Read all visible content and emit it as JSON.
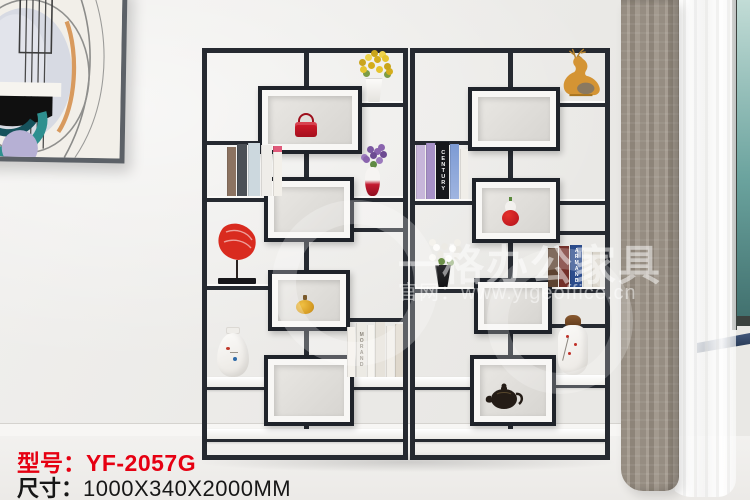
{
  "product": {
    "model_label": "型号：",
    "model_value": "YF-2057G",
    "size_label": "尺寸：",
    "size_value": "1000X340X2000MM"
  },
  "watermark": {
    "brand": "一格办公家具",
    "website": "官网：www.yigeoffice.cn"
  },
  "book_spines": {
    "century": "CENTURY",
    "morand": "MORAND",
    "armand": "ARMAND"
  },
  "colors": {
    "accent_red": "#e60012",
    "frame_black": "#262a31",
    "box_frame_white": "#f8f7f5",
    "curtain_taupe": "#9d948a",
    "window_teal": "#5f948f",
    "wall": "#edecea",
    "floor": "#f1f0ee"
  },
  "scene": {
    "subject": "two-bay black metal display shelf with staggered white shadow boxes",
    "decor_items": [
      "yellow-flowers-in-bucket",
      "red-handbag",
      "assorted-books",
      "purple-flowers-vase",
      "red-coral-sculpture",
      "gold-pumpkin-ornament",
      "white-porcelain-vase",
      "white-book-set",
      "gold-deer-figurine",
      "red-gourd-vase",
      "white-flowers-in-black-pot",
      "blue-book-set",
      "floral-painted-vase",
      "black-teapot"
    ],
    "environment": [
      "abstract-wall-art",
      "taupe-curtain",
      "sheer-curtain",
      "window",
      "window-sill"
    ]
  }
}
